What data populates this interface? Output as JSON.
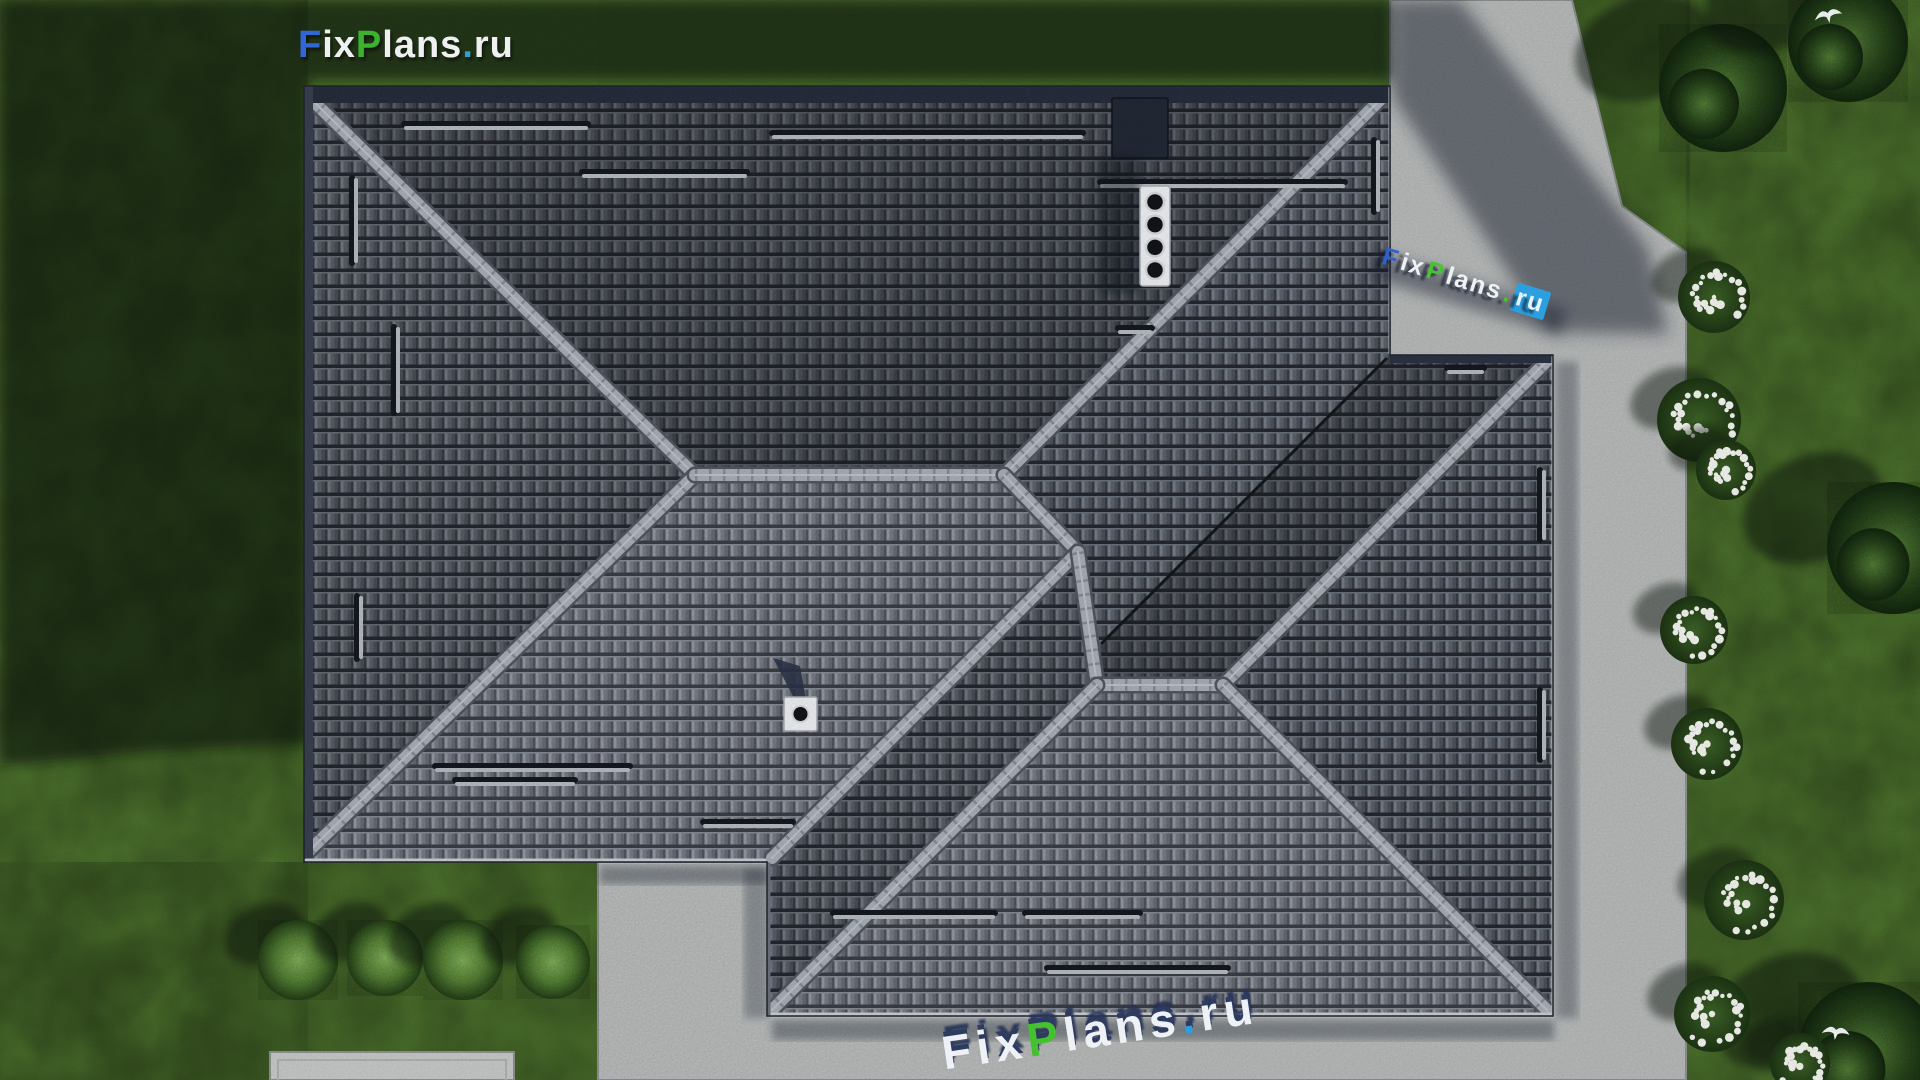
{
  "page": {
    "title": "FixPlans.ru house roof plan aerial 3D render",
    "width": 1920,
    "height": 1080
  },
  "branding": {
    "logo_parts": [
      {
        "t": "F",
        "c": "#3066d6"
      },
      {
        "t": "ix",
        "c": "#eef0f2"
      },
      {
        "t": "P",
        "c": "#3cb32e"
      },
      {
        "t": "lans",
        "c": "#eef0f2"
      },
      {
        "t": ".",
        "c": "#2e9fd6"
      },
      {
        "t": "ru",
        "c": "#eef0f2"
      }
    ],
    "ground_watermark_parts": [
      {
        "t": "F",
        "c": "#eef1f5"
      },
      {
        "t": "ix",
        "c": "#eef1f5"
      },
      {
        "t": "P",
        "c": "#45c02f"
      },
      {
        "t": "lans",
        "c": "#eef1f5"
      },
      {
        "t": ".",
        "c": "#2b9fe0"
      },
      {
        "t": "ru",
        "c": "#eef1f5"
      }
    ],
    "side_watermark_parts": [
      {
        "t": "F",
        "c": "#2f5fd0"
      },
      {
        "t": "ix",
        "c": "#eef1f5"
      },
      {
        "t": "P",
        "c": "#46c432"
      },
      {
        "t": "lans",
        "c": "#eef1f5"
      },
      {
        "t": ".",
        "c": "#46c432"
      },
      {
        "t": "ru",
        "c": "#e8f4fb",
        "bg": "#2b9fe0"
      }
    ]
  },
  "palette": {
    "grass": "#4e742e",
    "grass_shadow": "#0b150b",
    "pavement": "#bcbfbe",
    "pavement_edge": "#8f9494",
    "tile_base": "#6d727b",
    "tile_gap": "#2a2d33",
    "ridge": "#a8adb5",
    "ridge_edge": "#51565f",
    "ridge_tick": "#858b95",
    "valley": "#14171c",
    "fascia": "#2b3242",
    "fascia_left": "#39404e",
    "gutter_light": "#c6c9ce",
    "snow_guard_dark": "#15181e",
    "snow_guard_light": "#b4bac1",
    "chimney_cap": "#eceef1",
    "chimney_stack": "#232836",
    "vent_hole": "#121419",
    "vent_ring": "#d5d8dd",
    "bush_light": "#86b75e",
    "bush_dark": "#27441a",
    "tree_dark": "#142a10",
    "flower_white": "#f3f4ef",
    "slab": "#c6c8c7",
    "bird_white": "#f5f7f9"
  },
  "roof": {
    "outline": [
      [
        304,
        86
      ],
      [
        1390,
        86
      ],
      [
        1390,
        355
      ],
      [
        1553,
        355
      ],
      [
        1553,
        1016
      ],
      [
        767,
        1016
      ],
      [
        767,
        862
      ],
      [
        304,
        862
      ]
    ],
    "faces": [
      {
        "name": "north-main",
        "points": [
          [
            304,
            86
          ],
          [
            1390,
            86
          ],
          [
            1004,
            475
          ],
          [
            695,
            475
          ]
        ],
        "shade": "rgba(13,16,22,0.36)"
      },
      {
        "name": "west-main",
        "points": [
          [
            304,
            86
          ],
          [
            695,
            475
          ],
          [
            304,
            862
          ]
        ],
        "shade": "rgba(16,19,25,0.20)"
      },
      {
        "name": "south-main",
        "points": [
          [
            304,
            862
          ],
          [
            695,
            475
          ],
          [
            1004,
            475
          ],
          [
            1078,
            552
          ],
          [
            770,
            862
          ]
        ],
        "shade": "rgba(225,230,238,0.10)"
      },
      {
        "name": "east-main",
        "points": [
          [
            1390,
            86
          ],
          [
            1390,
            355
          ],
          [
            1100,
            645
          ],
          [
            1078,
            552
          ],
          [
            1004,
            475
          ]
        ],
        "shade": "rgba(16,19,25,0.15)"
      },
      {
        "name": "north-wing",
        "points": [
          [
            1390,
            355
          ],
          [
            1553,
            355
          ],
          [
            1223,
            685
          ],
          [
            1097,
            685
          ],
          [
            1100,
            645
          ]
        ],
        "shade": "rgba(13,16,22,0.36)"
      },
      {
        "name": "east-wing",
        "points": [
          [
            1553,
            355
          ],
          [
            1553,
            1016
          ],
          [
            1223,
            685
          ]
        ],
        "shade": "rgba(16,19,25,0.15)"
      },
      {
        "name": "south-wing",
        "points": [
          [
            767,
            1016
          ],
          [
            1553,
            1016
          ],
          [
            1223,
            685
          ],
          [
            1097,
            685
          ]
        ],
        "shade": "rgba(225,230,238,0.10)"
      },
      {
        "name": "west-wing",
        "points": [
          [
            767,
            862
          ],
          [
            1078,
            552
          ],
          [
            1097,
            685
          ],
          [
            767,
            1016
          ]
        ],
        "shade": "rgba(16,19,25,0.20)"
      }
    ],
    "ridges": [
      [
        310,
        98,
        695,
        475
      ],
      [
        310,
        850,
        695,
        475
      ],
      [
        695,
        475,
        1004,
        475
      ],
      [
        1004,
        475,
        1384,
        96
      ],
      [
        1004,
        475,
        1078,
        552
      ],
      [
        1078,
        552,
        772,
        858
      ],
      [
        1078,
        552,
        1097,
        685
      ],
      [
        1097,
        685,
        1223,
        685
      ],
      [
        1097,
        685,
        772,
        1010
      ],
      [
        1223,
        685,
        1548,
        360
      ],
      [
        1223,
        685,
        1548,
        1011
      ]
    ],
    "valleys": [
      [
        1386,
        359,
        1102,
        643
      ]
    ],
    "fascia": {
      "top": [
        304,
        86,
        1086,
        17
      ],
      "left": [
        304,
        86,
        9,
        776
      ],
      "wing_top": [
        1390,
        355,
        163,
        8
      ]
    },
    "edge_lines": [
      [
        1390,
        88,
        1390,
        353,
        "#c2c6cb",
        3
      ],
      [
        1553,
        357,
        1553,
        1014,
        "#c2c6cb",
        3
      ],
      [
        769,
        1014,
        1551,
        1014,
        "#c9ccd1",
        3
      ],
      [
        306,
        860,
        765,
        860,
        "#c9ccd1",
        3
      ],
      [
        769,
        864,
        769,
        1014,
        "#6a717c",
        3
      ]
    ],
    "snow_guards_h": [
      [
        404,
        588,
        124
      ],
      [
        772,
        1083,
        133
      ],
      [
        582,
        747,
        172
      ],
      [
        1100,
        1345,
        182
      ],
      [
        1118,
        1152,
        328
      ],
      [
        1447,
        1484,
        368
      ],
      [
        435,
        630,
        766
      ],
      [
        455,
        575,
        780
      ],
      [
        703,
        793,
        822
      ],
      [
        833,
        995,
        913
      ],
      [
        1025,
        1140,
        913
      ],
      [
        1047,
        1228,
        968
      ],
      [
        688,
        758,
        996
      ]
    ],
    "snow_guards_v": [
      [
        352,
        178,
        263
      ],
      [
        394,
        327,
        413
      ],
      [
        357,
        596,
        659
      ],
      [
        1374,
        140,
        212
      ],
      [
        1540,
        470,
        540
      ],
      [
        1540,
        690,
        760
      ]
    ],
    "chimney": {
      "x": 1140,
      "y": 186,
      "w": 30,
      "h": 100,
      "vents": 4,
      "stack": {
        "x": 1112,
        "y": 98,
        "w": 56,
        "h": 60
      }
    },
    "vent_box": {
      "x": 784,
      "y": 697,
      "w": 33,
      "h": 34
    }
  },
  "ground": {
    "pavement_points": [
      [
        1390,
        0
      ],
      [
        1572,
        0
      ],
      [
        1622,
        206
      ],
      [
        1686,
        252
      ],
      [
        1686,
        1080
      ],
      [
        598,
        1080
      ],
      [
        598,
        862
      ],
      [
        1390,
        862
      ]
    ],
    "slab": {
      "x": 270,
      "y": 1052,
      "w": 244,
      "h": 28
    },
    "round_bushes": [
      [
        298,
        960,
        40
      ],
      [
        385,
        958,
        38
      ],
      [
        463,
        960,
        40
      ],
      [
        553,
        962,
        37
      ]
    ],
    "trees": [
      [
        1723,
        88,
        64
      ],
      [
        1848,
        42,
        60
      ],
      [
        1893,
        548,
        66
      ],
      [
        1868,
        1052,
        70
      ]
    ],
    "flower_bushes": [
      [
        1714,
        297,
        36
      ],
      [
        1699,
        420,
        42
      ],
      [
        1726,
        470,
        30
      ],
      [
        1694,
        630,
        34
      ],
      [
        1707,
        744,
        36
      ],
      [
        1744,
        900,
        40
      ],
      [
        1712,
        1014,
        38
      ],
      [
        1800,
        1063,
        30
      ]
    ],
    "birds": [
      [
        1828,
        14,
        -10
      ],
      [
        1836,
        1031,
        8
      ]
    ],
    "grass_mottle_rects": [
      [
        0,
        0,
        308,
        1080
      ],
      [
        0,
        862,
        600,
        218
      ],
      [
        1686,
        0,
        234,
        1080
      ],
      [
        1560,
        0,
        130,
        255
      ]
    ],
    "shadows": {
      "house": [
        [
          0,
          0
        ],
        [
          1392,
          0
        ],
        [
          1392,
          80
        ],
        [
          308,
          80
        ],
        [
          308,
          744
        ],
        [
          150,
          752
        ],
        [
          0,
          766
        ]
      ],
      "wedge": [
        [
          1392,
          0
        ],
        [
          1460,
          0
        ],
        [
          1648,
          248
        ],
        [
          1668,
          334
        ],
        [
          1548,
          332
        ],
        [
          1392,
          96
        ]
      ],
      "strips": [
        [
          1556,
          362,
          22,
          656,
          0.32
        ],
        [
          772,
          1020,
          782,
          20,
          0.38
        ],
        [
          600,
          866,
          168,
          18,
          0.38
        ],
        [
          744,
          868,
          24,
          150,
          0.3
        ]
      ]
    }
  }
}
